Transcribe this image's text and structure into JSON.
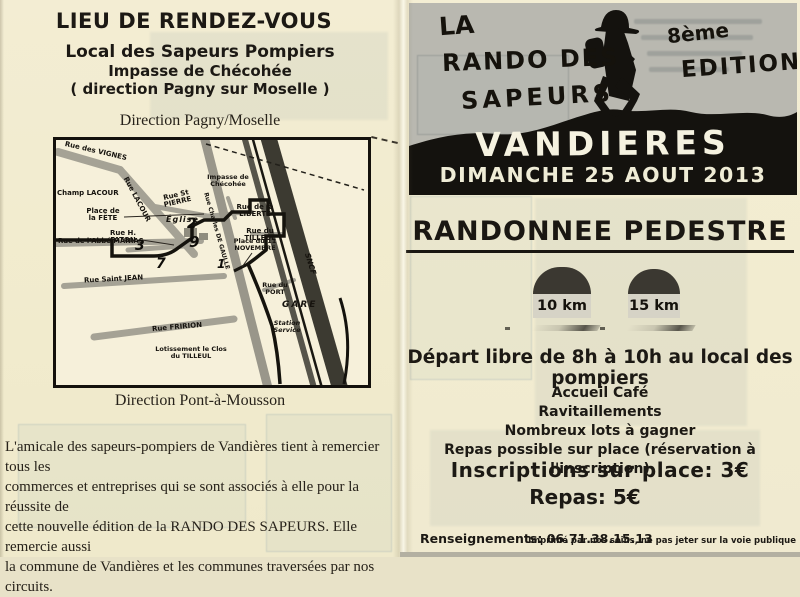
{
  "left": {
    "title": "LIEU DE RENDEZ-VOUS",
    "venue": {
      "line1": "Local des Sapeurs Pompiers",
      "line2": "Impasse de Chécohée",
      "line3": "( direction Pagny sur Moselle )"
    },
    "direction_top": "Direction Pagny/Moselle",
    "direction_bottom": "Direction Pont-à-Mousson",
    "thanks_lines": [
      "L'amicale des sapeurs-pompiers de Vandières tient à remercier tous les",
      "commerces et entreprises qui se sont associés à elle pour la réussite de",
      "cette nouvelle édition de la RANDO DES SAPEURS. Elle remercie aussi",
      "la commune de Vandières et les communes traversées par nos circuits."
    ],
    "map": {
      "labels": [
        "Rue des VIGNES",
        "Champ LACOUR",
        "Rue LACOUR",
        "Rue St PIERRE",
        "Impasse de Chécohée",
        "Place de la FÊTE",
        "Église",
        "Rue de la LIBERTÉ",
        "Rue du TILLEUL",
        "Rue H. FATON",
        "Rue de l'Abbé MANIAS",
        "Rue Saint JEAN",
        "Place du 11 NOVEMBRE",
        "Rue du PORT",
        "GARE",
        "SNCF",
        "Rue FRIRION",
        "Station Service",
        "Lotissement le Clos du TILLEUL",
        "Rue Charles DE GAULLE"
      ],
      "numbers": [
        "3",
        "7",
        "2",
        "9",
        "1"
      ]
    }
  },
  "right": {
    "header": {
      "la": "LA",
      "rando": "RANDO DES",
      "sapeurs": "SAPEURS",
      "edition_num": "8ème",
      "edition_word": "EDITION",
      "town": "VANDIERES",
      "date": "DIMANCHE 25 AOUT 2013"
    },
    "event_title": "RANDONNEE PEDESTRE",
    "distances": [
      "10 km",
      "15 km"
    ],
    "depart": "Départ libre de 8h à 10h au local des pompiers",
    "amenities": [
      "Accueil Café",
      "Ravitaillements",
      "Nombreux lots à gagner",
      "Repas possible sur place (réservation à l'inscription)"
    ],
    "prices": {
      "inscription": "Inscriptions sur place: 3€",
      "repas": "Repas: 5€"
    },
    "footer": {
      "contact": "Renseignements: 06.71.38.15.13",
      "note": "Imprimé par nos soins, ne pas jeter sur la voie publique"
    }
  },
  "colors": {
    "paper": "#f2ecd2",
    "ink": "#1c1914",
    "header_gray": "#b9b8b0",
    "silhouette_black": "#14120e"
  }
}
